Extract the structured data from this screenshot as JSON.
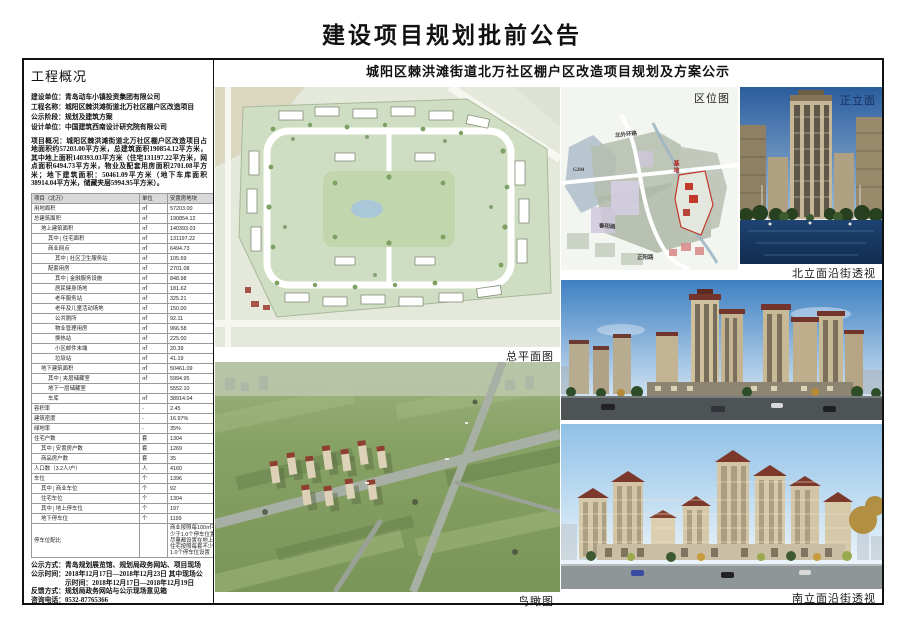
{
  "page": {
    "title": "建设项目规划批前公告"
  },
  "left": {
    "header": "工程概况",
    "info": [
      {
        "label": "建设单位：",
        "text": "青岛动车小镇投资集团有限公司"
      },
      {
        "label": "工程名称：",
        "text": "城阳区棘洪滩街道北万社区棚户区改造项目"
      },
      {
        "label": "公示阶段：",
        "text": "规划及建筑方案"
      },
      {
        "label": "设计单位：",
        "text": "中国建筑西南设计研究院有限公司"
      }
    ],
    "overview": "项目概况：城阳区棘洪滩街道北万社区棚户区改造项目占地面积约57203.00平方米，总建筑面积190854.12平方米，其中地上面积140393.03平方米（住宅131197.22平方米，网点面积6494.73平方米，物业及配套用房面积2701.08平方米；地下建筑面积：50461.09平方米（地下车库面积38914.04平方米，储藏夹层5994.95平方米）。",
    "table": {
      "headers": [
        "项目（北万）",
        "单位",
        "安置房地块"
      ],
      "rows": [
        {
          "n": "用地面积",
          "u": "㎡",
          "v": "57203.00",
          "i": 0
        },
        {
          "n": "总建筑面积",
          "u": "㎡",
          "v": "190854.12",
          "i": 0
        },
        {
          "n": "地上建筑面积",
          "u": "㎡",
          "v": "140393.03",
          "i": 1
        },
        {
          "n": "住宅面积",
          "u": "㎡",
          "v": "131197.22",
          "i": 2,
          "p": "其中"
        },
        {
          "n": "商业网点",
          "u": "㎡",
          "v": "6494.73",
          "i": 2
        },
        {
          "n": "社区卫生服务站",
          "u": "㎡",
          "v": "105.69",
          "i": 3,
          "p": "其中"
        },
        {
          "n": "配套用房",
          "u": "㎡",
          "v": "2701.08",
          "i": 2
        },
        {
          "n": "金融服务设施",
          "u": "㎡",
          "v": "848.98",
          "i": 3,
          "p": "其中"
        },
        {
          "n": "居民健身场地",
          "u": "㎡",
          "v": "181.62",
          "i": 3
        },
        {
          "n": "老年服务站",
          "u": "㎡",
          "v": "325.21",
          "i": 3
        },
        {
          "n": "老年及儿童活动场地",
          "u": "㎡",
          "v": "150.00",
          "i": 3
        },
        {
          "n": "公共厕所",
          "u": "㎡",
          "v": "92.11",
          "i": 3
        },
        {
          "n": "物业管理用房",
          "u": "㎡",
          "v": "966.58",
          "i": 3
        },
        {
          "n": "换热站",
          "u": "㎡",
          "v": "225.00",
          "i": 3
        },
        {
          "n": "小区邮件末端",
          "u": "㎡",
          "v": "20.39",
          "i": 3
        },
        {
          "n": "垃圾站",
          "u": "㎡",
          "v": "41.19",
          "i": 3
        },
        {
          "n": "地下建筑面积",
          "u": "㎡",
          "v": "50461.09",
          "i": 1
        },
        {
          "n": "夹层储藏室",
          "u": "㎡",
          "v": "5994.95",
          "i": 2,
          "p": "其中"
        },
        {
          "n": "地下一层储藏室",
          "u": "",
          "v": "5552.10",
          "i": 2
        },
        {
          "n": "车库",
          "u": "㎡",
          "v": "38914.04",
          "i": 2
        },
        {
          "n": "容积率",
          "u": "-",
          "v": "2.45",
          "i": 0
        },
        {
          "n": "建筑密度",
          "u": "-",
          "v": "16.97%",
          "i": 0
        },
        {
          "n": "绿地率",
          "u": "-",
          "v": "35%",
          "i": 0
        },
        {
          "n": "住宅户数",
          "u": "套",
          "v": "1304",
          "i": 0
        },
        {
          "n": "安置房户数",
          "u": "套",
          "v": "1269",
          "i": 1,
          "p": "其中"
        },
        {
          "n": "商品房户数",
          "u": "套",
          "v": "35",
          "i": 1
        },
        {
          "n": "人口数（3.2人/户）",
          "u": "人",
          "v": "4160",
          "i": 0
        },
        {
          "n": "车位",
          "u": "个",
          "v": "1396",
          "i": 0
        },
        {
          "n": "商业车位",
          "u": "个",
          "v": "92",
          "i": 1,
          "p": "其中"
        },
        {
          "n": "住宅车位",
          "u": "个",
          "v": "1304",
          "i": 1
        },
        {
          "n": "地上停车位",
          "u": "个",
          "v": "197",
          "i": 1,
          "p": "其中"
        },
        {
          "n": "地下停车位",
          "u": "个",
          "v": "1199",
          "i": 1
        },
        {
          "n": "停车位配比",
          "u": "",
          "v": "商业按照每100㎡不少于1.0个停车位置，尽量都设置在地上，住宅按照每套不少于1.0个停车位设置",
          "i": 0,
          "wrap": true
        }
      ]
    },
    "footer": [
      {
        "label": "公示方式：",
        "text": "青岛规划展览馆、规划局政务网站、项目现场"
      },
      {
        "label": "公示时间：",
        "text": "2018年12月17日—2018年12月23日 其中现场公示时间：2018年12月17日—2018年12月19日"
      },
      {
        "label": "反馈方式：",
        "text": "规划局政务网站与公示现场意见箱"
      },
      {
        "label": "咨询电话：",
        "text": "0532-87765366"
      }
    ]
  },
  "main": {
    "subtitle": "城阳区棘洪滩街道北万社区棚户区改造项目规划及方案公示",
    "captions": {
      "siteplan": "总平面图",
      "aerial": "鸟瞰图",
      "location": "区位图",
      "front": "正立面",
      "north": "北立面沿街透视",
      "south": "南立面沿街透视"
    },
    "map_labels": {
      "road_top": "北外环路",
      "highway": "G204",
      "road_mid": "春阳路",
      "road_bottom": "正阳路",
      "site": "基地"
    }
  },
  "colors": {
    "site_plan_green": "#cfdec2",
    "field_green": "#83a061",
    "sky_blue": "#4a86c6",
    "roof_red": "#7e3a2c",
    "site_red": "#c0392b",
    "table_header_grey": "#d9d9d9"
  }
}
